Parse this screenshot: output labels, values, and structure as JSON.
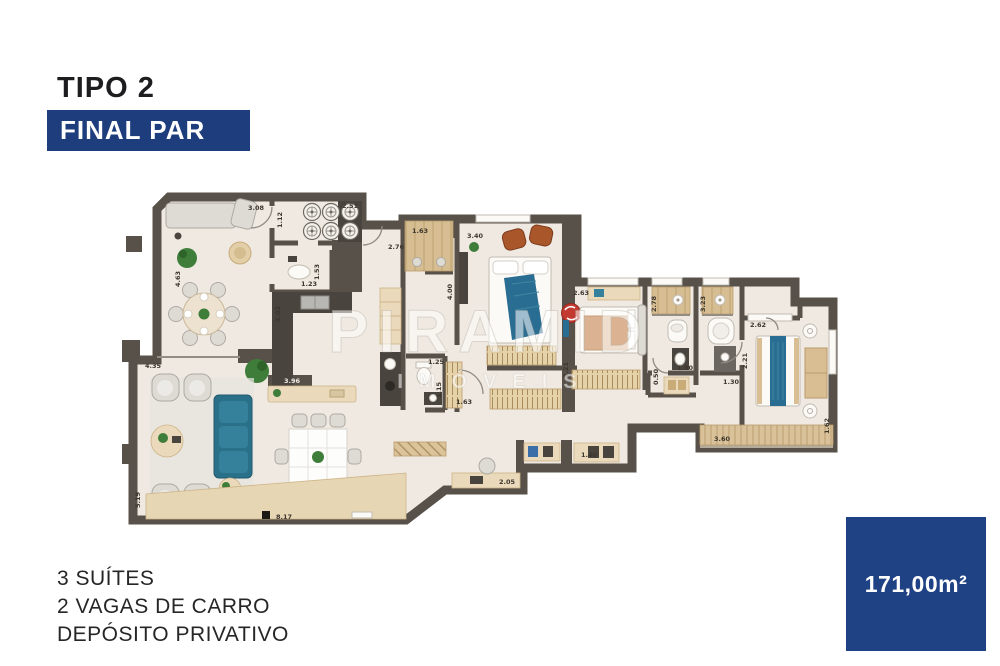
{
  "header": {
    "title": "TIPO 2",
    "badge": "FINAL PAR"
  },
  "features": [
    "3 SUÍTES",
    "2 VAGAS DE CARRO",
    "DEPÓSITO PRIVATIVO"
  ],
  "area_box": {
    "value": "171,00m²"
  },
  "watermark": {
    "line1": "PIRAMID",
    "line2": "IMÓVEIS"
  },
  "colors": {
    "badge_blue": "#1e3d7d",
    "area_blue": "#1f4284",
    "wall": "#57514a",
    "floor": "#efe9e1",
    "wood": "#d9c299",
    "sofa_teal": "#2b7089",
    "bed_blue": "#2a6d92"
  },
  "floorplan": {
    "dimension_labels": [
      {
        "t": "3.08",
        "x": 248,
        "y": 210
      },
      {
        "t": "2.51",
        "x": 342,
        "y": 208
      },
      {
        "t": "1.12",
        "x": 282,
        "y": 228,
        "v": 1
      },
      {
        "t": "1.63",
        "x": 412,
        "y": 233
      },
      {
        "t": "3.40",
        "x": 467,
        "y": 238
      },
      {
        "t": "2.76",
        "x": 388,
        "y": 249
      },
      {
        "t": "4.63",
        "x": 180,
        "y": 287,
        "v": 1
      },
      {
        "t": "1.23",
        "x": 301,
        "y": 286
      },
      {
        "t": "1.53",
        "x": 319,
        "y": 280,
        "v": 1
      },
      {
        "t": "3.02",
        "x": 280,
        "y": 322,
        "v": 1
      },
      {
        "t": "4.00",
        "x": 452,
        "y": 300,
        "v": 1
      },
      {
        "t": "2.63",
        "x": 573,
        "y": 295
      },
      {
        "t": "2.78",
        "x": 656,
        "y": 312,
        "v": 1
      },
      {
        "t": "3.23",
        "x": 705,
        "y": 312,
        "v": 1
      },
      {
        "t": "2.62",
        "x": 750,
        "y": 327
      },
      {
        "t": "4.35",
        "x": 145,
        "y": 368
      },
      {
        "t": "3.96",
        "x": 284,
        "y": 383,
        "light": 1
      },
      {
        "t": "1.25",
        "x": 428,
        "y": 364
      },
      {
        "t": "1.15",
        "x": 441,
        "y": 398,
        "v": 1
      },
      {
        "t": "1.63",
        "x": 456,
        "y": 404
      },
      {
        "t": "2.21",
        "x": 747,
        "y": 369,
        "v": 1
      },
      {
        "t": "1.30",
        "x": 677,
        "y": 370
      },
      {
        "t": "0.50",
        "x": 658,
        "y": 385,
        "v": 1
      },
      {
        "t": "1.30",
        "x": 723,
        "y": 384
      },
      {
        "t": "3.21",
        "x": 568,
        "y": 378,
        "v": 1
      },
      {
        "t": "2.05",
        "x": 499,
        "y": 484
      },
      {
        "t": "1.40",
        "x": 581,
        "y": 457
      },
      {
        "t": "8.17",
        "x": 276,
        "y": 519
      },
      {
        "t": "5.19",
        "x": 140,
        "y": 508,
        "v": 1
      },
      {
        "t": "3.60",
        "x": 714,
        "y": 441
      },
      {
        "t": "1.62",
        "x": 829,
        "y": 434,
        "v": 1
      }
    ]
  }
}
